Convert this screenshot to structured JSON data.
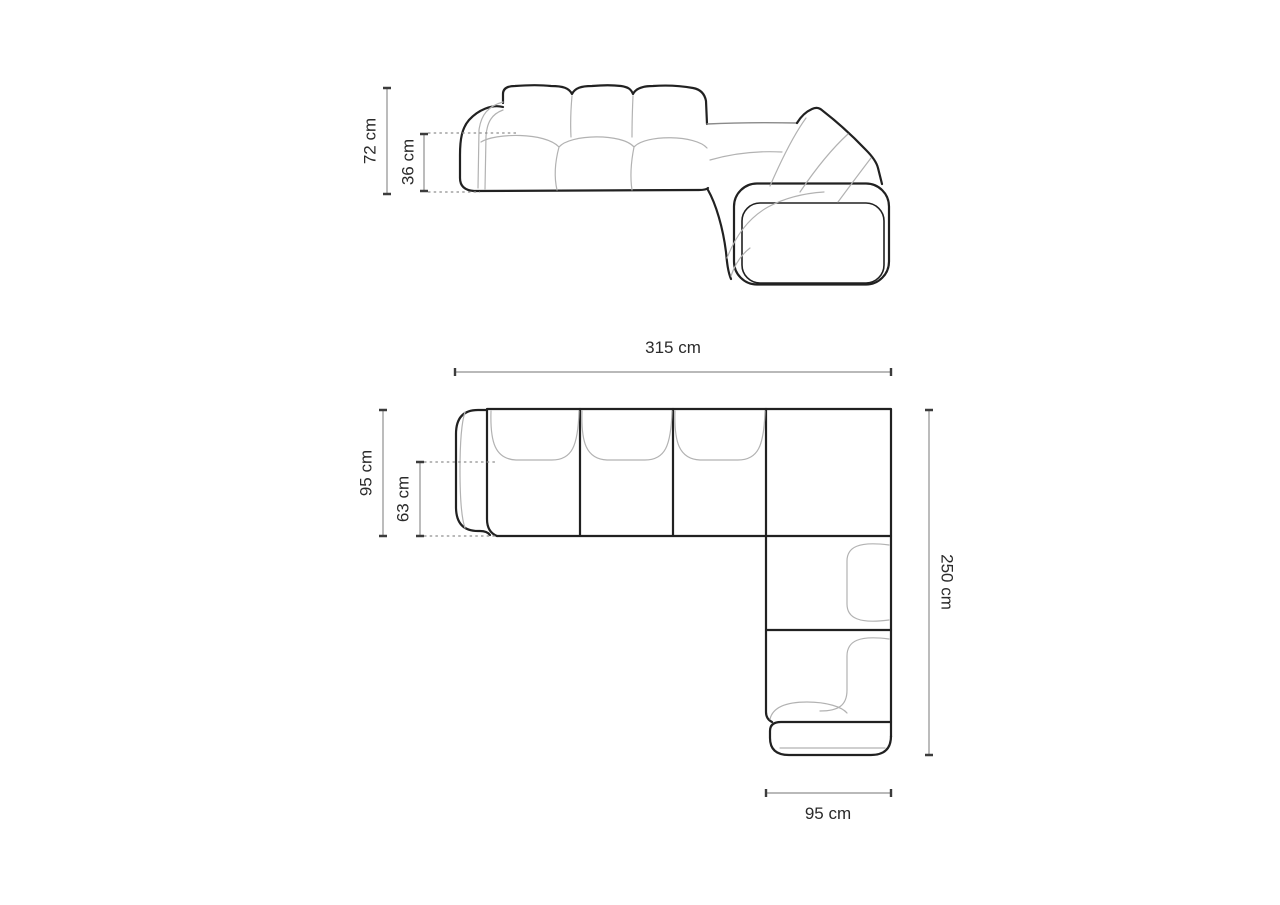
{
  "dimensions": {
    "front_height": "72 cm",
    "front_seat_height": "36 cm",
    "plan_width": "315 cm",
    "plan_depth": "95 cm",
    "plan_seat_depth": "63 cm",
    "plan_side_length": "250 cm",
    "plan_chaise_width": "95 cm"
  },
  "colors": {
    "outline": "#212121",
    "seam": "#b2b2b2",
    "seam_mid": "#8a8a8a",
    "dim_line": "#8f8f8f",
    "dim_tick": "#3c3c3c",
    "label_text": "#2b2b2b",
    "background": "#ffffff"
  }
}
